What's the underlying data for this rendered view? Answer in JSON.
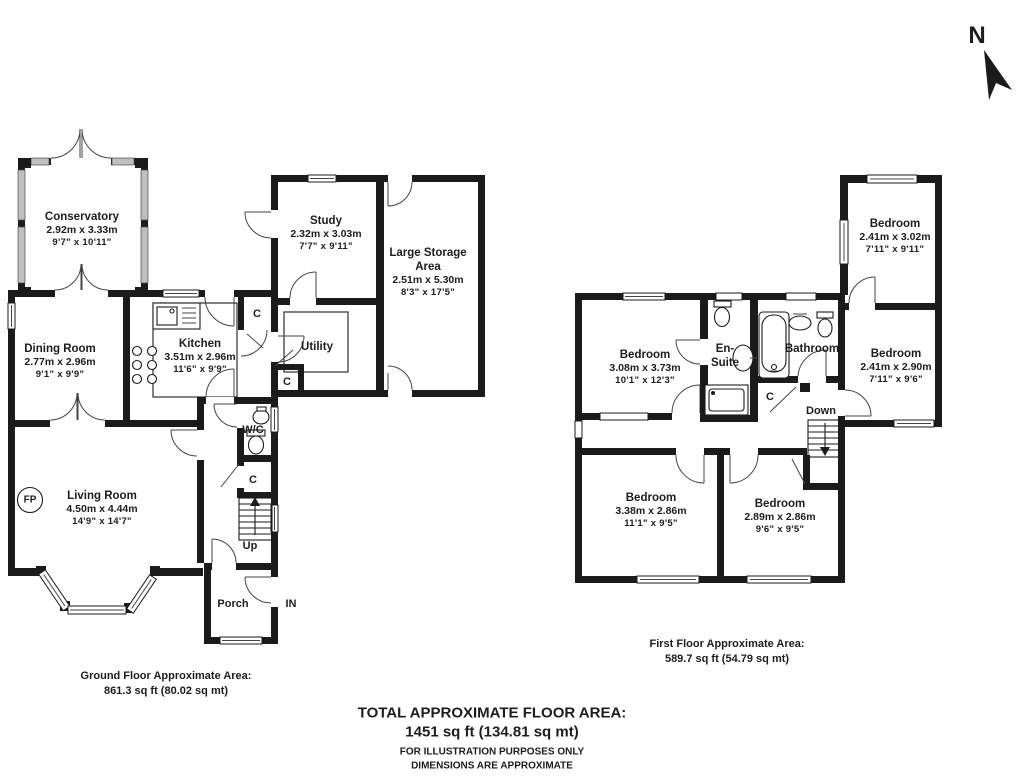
{
  "palette": {
    "wall": "#1b1b1b",
    "text": "#1d1d1d",
    "glazing": "#bfbfbf"
  },
  "compass": {
    "label": "N"
  },
  "ground_floor": {
    "rooms": {
      "conservatory": {
        "name": "Conservatory",
        "metric": "2.92m x 3.33m",
        "imperial": "9'7\" x 10'11\""
      },
      "dining_room": {
        "name": "Dining Room",
        "metric": "2.77m x 2.96m",
        "imperial": "9'1\" x 9'9\""
      },
      "kitchen": {
        "name": "Kitchen",
        "metric": "3.51m x 2.96m",
        "imperial": "11'6\" x 9'9\""
      },
      "study": {
        "name": "Study",
        "metric": "2.32m x 3.03m",
        "imperial": "7'7\" x 9'11\""
      },
      "storage": {
        "name": "Large Storage Area",
        "metric": "2.51m x 5.30m",
        "imperial": "8'3\" x 17'5\""
      },
      "utility": {
        "name": "Utility"
      },
      "living_room": {
        "name": "Living Room",
        "metric": "4.50m x 4.44m",
        "imperial": "14'9\" x 14'7\""
      },
      "wc": {
        "name": "W/C"
      },
      "porch": {
        "name": "Porch"
      }
    },
    "markers": {
      "up": "Up",
      "entrance": "IN",
      "fireplace": "FP",
      "cupboard": "C"
    },
    "area": {
      "title": "Ground Floor Approximate Area:",
      "value": "861.3 sq ft (80.02 sq mt)"
    }
  },
  "first_floor": {
    "rooms": {
      "bedroom_front": {
        "name": "Bedroom",
        "metric": "3.08m x 3.73m",
        "imperial": "10'1\" x 12'3\""
      },
      "ensuite": {
        "name_line1": "En-",
        "name_line2": "Suite"
      },
      "bathroom": {
        "name": "Bathroom"
      },
      "bedroom_top_right": {
        "name": "Bedroom",
        "metric": "2.41m x 3.02m",
        "imperial": "7'11\" x 9'11\""
      },
      "bedroom_right": {
        "name": "Bedroom",
        "metric": "2.41m x 2.90m",
        "imperial": "7'11\" x 9'6\""
      },
      "bedroom_back_left": {
        "name": "Bedroom",
        "metric": "3.38m x 2.86m",
        "imperial": "11'1\" x 9'5\""
      },
      "bedroom_back_right": {
        "name": "Bedroom",
        "metric": "2.89m x 2.86m",
        "imperial": "9'6\" x 9'5\""
      }
    },
    "markers": {
      "down": "Down",
      "cupboard": "C"
    },
    "area": {
      "title": "First Floor Approximate Area:",
      "value": "589.7 sq ft (54.79 sq mt)"
    }
  },
  "footer": {
    "total_title": "TOTAL APPROXIMATE FLOOR AREA:",
    "total_value": "1451 sq ft (134.81 sq mt)",
    "disclaimer_line1": "FOR ILLUSTRATION PURPOSES ONLY",
    "disclaimer_line2": "DIMENSIONS ARE APPROXIMATE"
  }
}
